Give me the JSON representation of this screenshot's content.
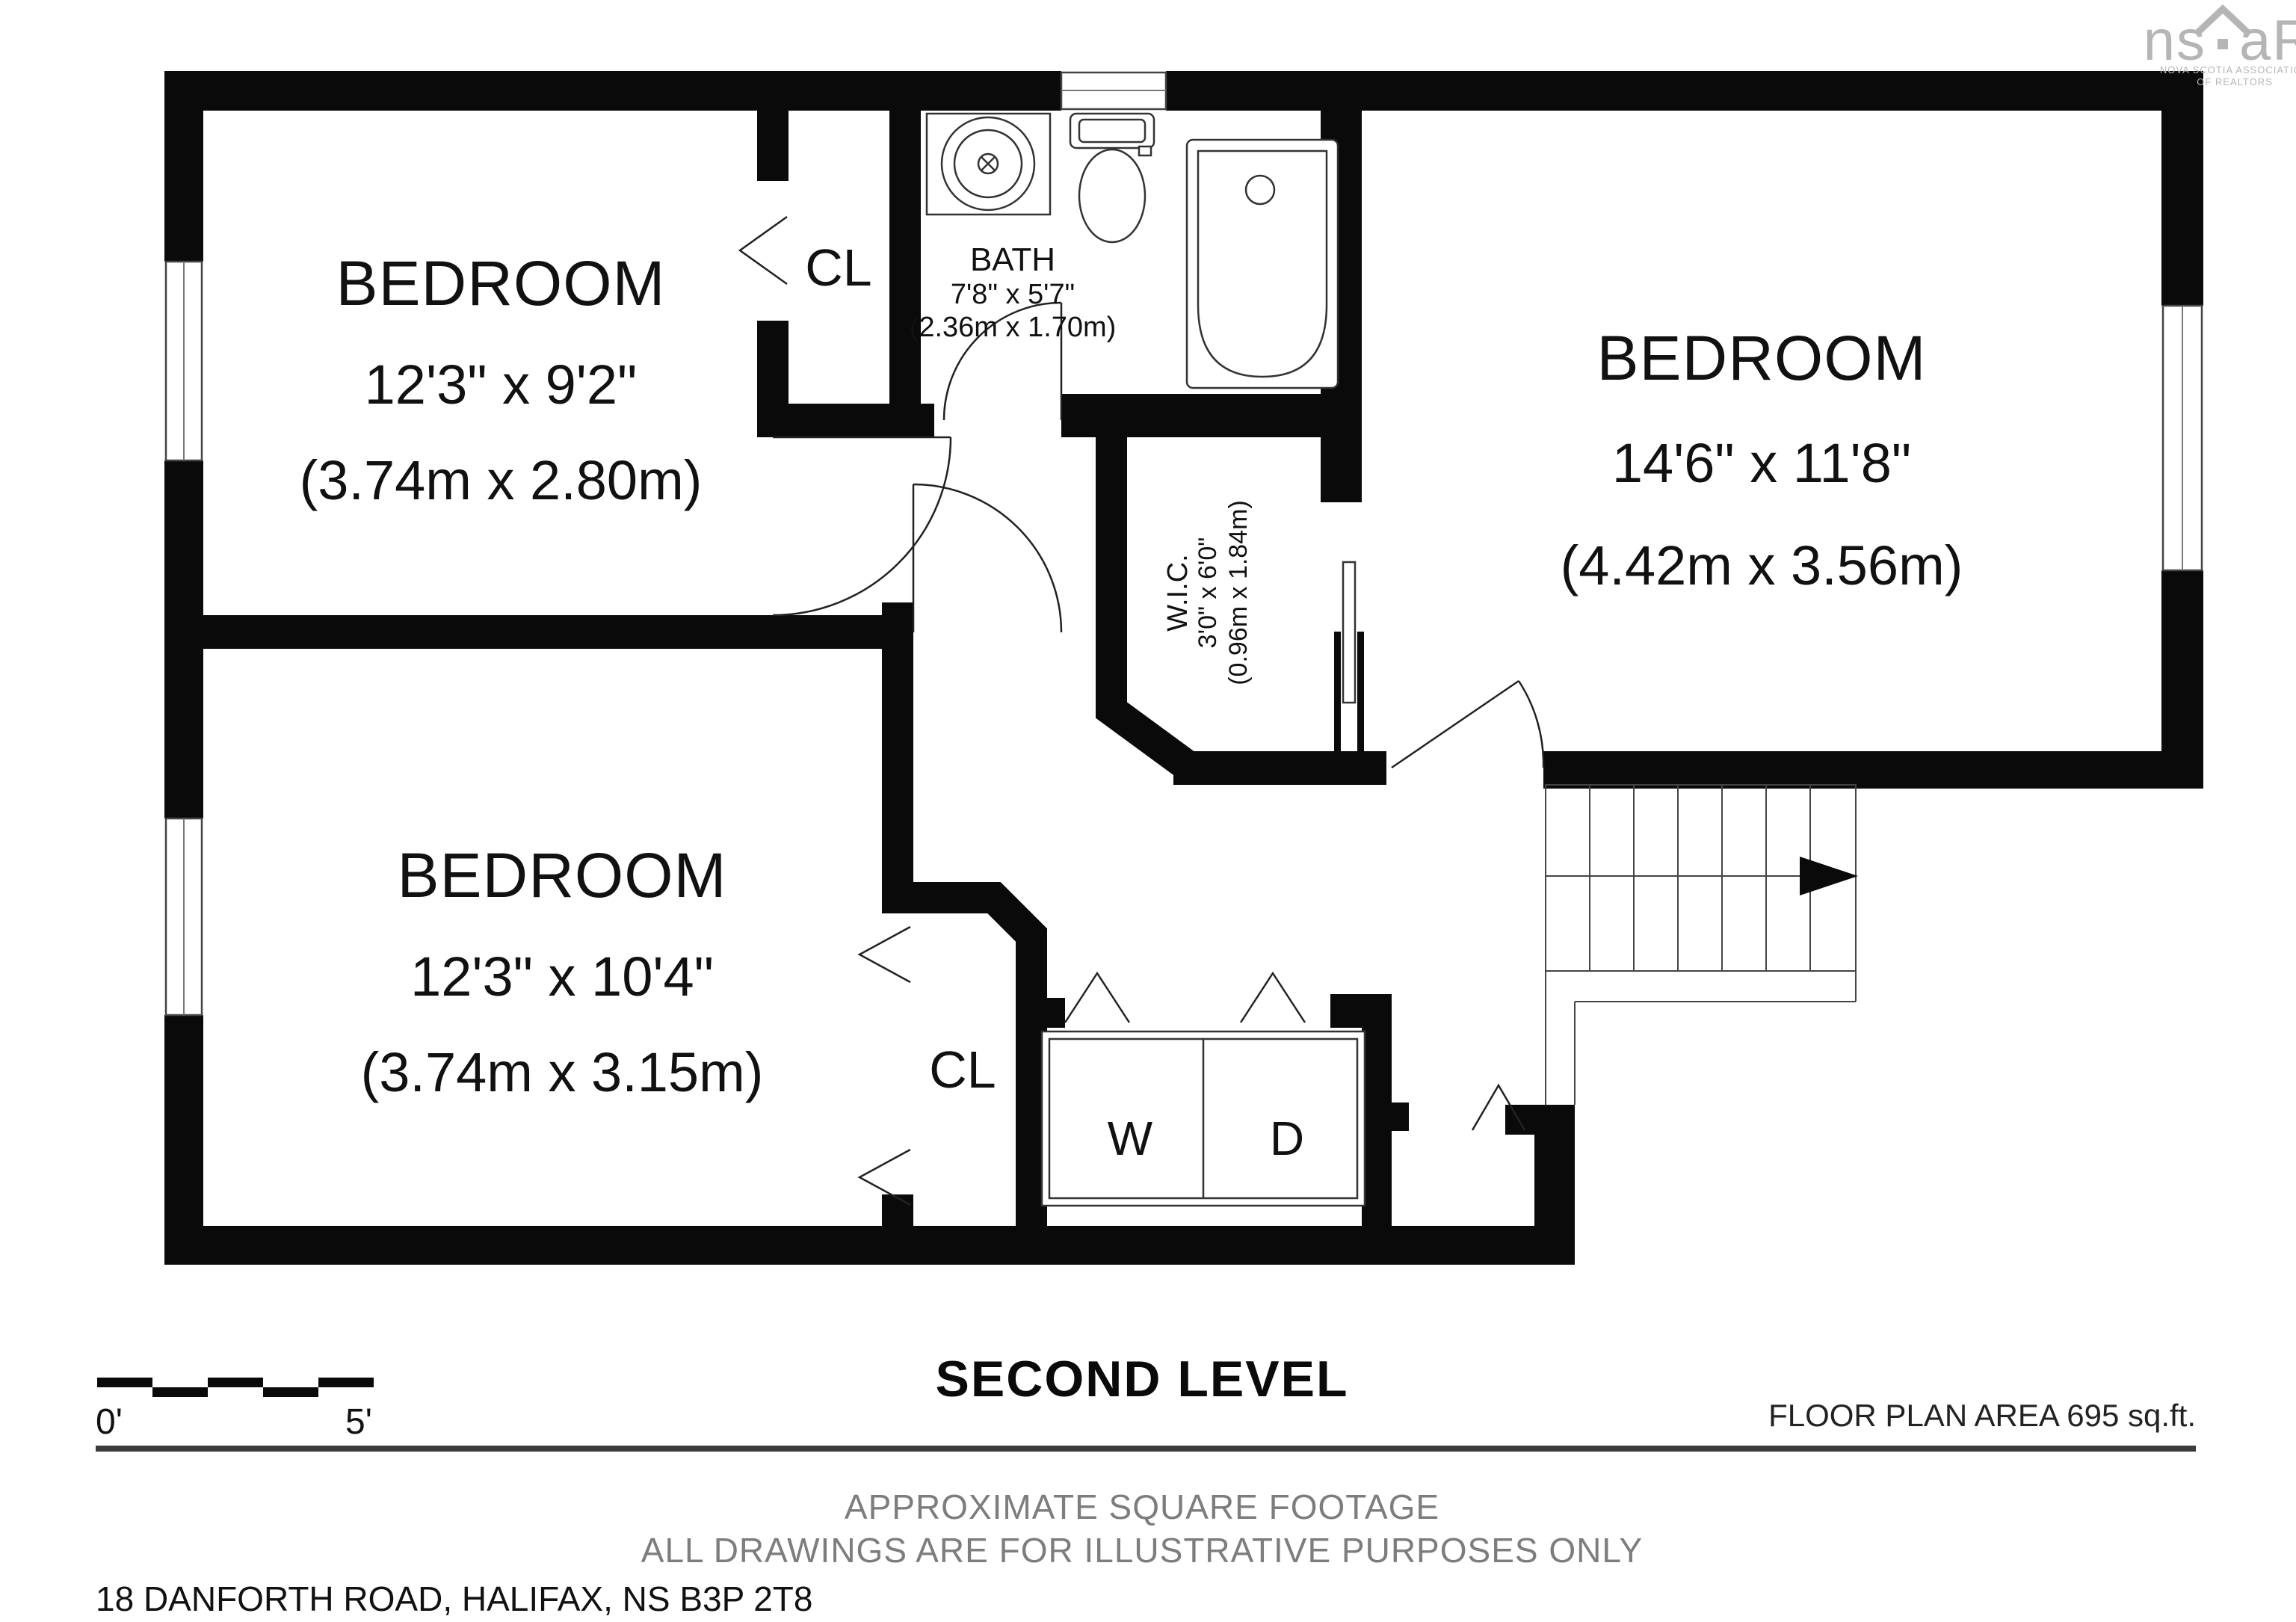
{
  "logo": {
    "brand_left": "ns",
    "brand_right": "aR",
    "caption_line1": "NOVA SCOTIA ASSOCIATION",
    "caption_line2": "OF REALTORS"
  },
  "rooms": {
    "bedroom_top_left": {
      "name": "BEDROOM",
      "size_imperial": "12'3\" x 9'2\"",
      "size_metric": "(3.74m x 2.80m)"
    },
    "bedroom_bottom_left": {
      "name": "BEDROOM",
      "size_imperial": "12'3\" x 10'4\"",
      "size_metric": "(3.74m x 3.15m)"
    },
    "bedroom_right": {
      "name": "BEDROOM",
      "size_imperial": "14'6\" x 11'8\"",
      "size_metric": "(4.42m x 3.56m)"
    },
    "bath": {
      "name": "BATH",
      "size_imperial": "7'8\" x 5'7\"",
      "size_metric": "(2.36m x 1.70m)"
    },
    "walk_in_closet": {
      "name": "W.I.C.",
      "size_imperial": "3'0\" x 6'0\"",
      "size_metric": "(0.96m x 1.84m)"
    },
    "closet_top": {
      "name": "CL"
    },
    "closet_bottom": {
      "name": "CL"
    },
    "washer": {
      "name": "W"
    },
    "dryer": {
      "name": "D"
    }
  },
  "footer": {
    "level_title": "SECOND LEVEL",
    "scale": {
      "start_label": "0'",
      "end_label": "5'"
    },
    "area_label": "FLOOR PLAN AREA 695 sq.ft.",
    "note_line1": "APPROXIMATE SQUARE FOOTAGE",
    "note_line2": "ALL DRAWINGS ARE FOR ILLUSTRATIVE PURPOSES ONLY",
    "address": "18 DANFORTH ROAD, HALIFAX, NS B3P 2T8"
  },
  "colors": {
    "wall": "#0a0a0a",
    "background": "#ffffff",
    "muted_text": "#7d7d7d",
    "logo_gray": "#b5b5b5",
    "rule": "#3b3b3b"
  }
}
